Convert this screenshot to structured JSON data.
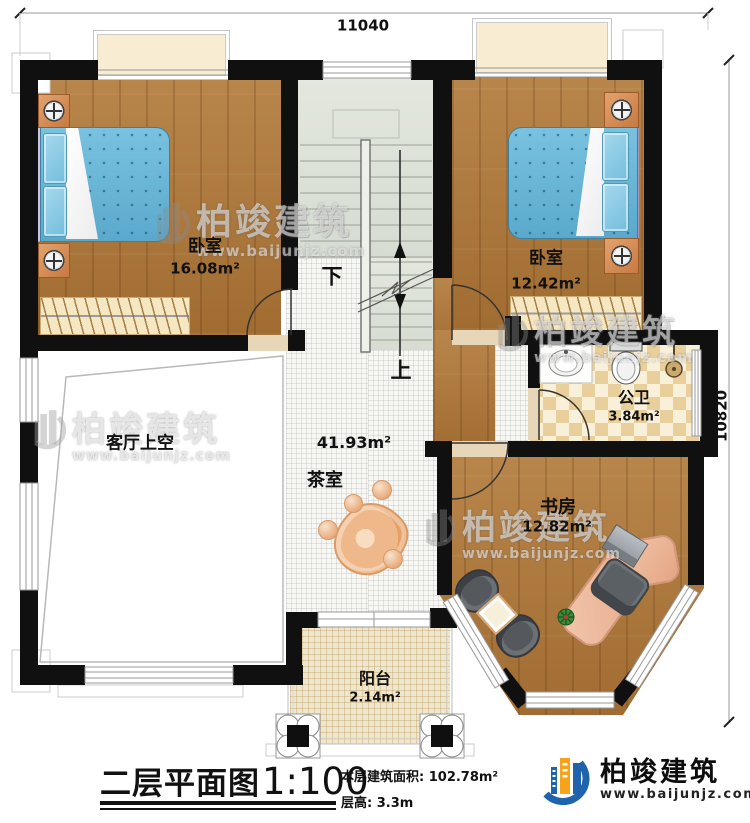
{
  "dimensions": {
    "top": "11040",
    "right": "10820"
  },
  "rooms": {
    "bedroom_left": {
      "name": "卧室",
      "area": "16.08m²"
    },
    "bedroom_right": {
      "name": "卧室",
      "area": "12.42m²"
    },
    "bathroom": {
      "name": "公卫",
      "area": "3.84m²"
    },
    "study": {
      "name": "书房",
      "area": "12.82m²"
    },
    "tea_room": {
      "name": "茶室",
      "area": "41.93m²"
    },
    "living_room_void": {
      "name": "客厅上空"
    },
    "balcony": {
      "name": "阳台",
      "area": "2.14m²"
    }
  },
  "stairs": {
    "down_label": "下",
    "up_label": "上"
  },
  "title_block": {
    "title": "二层平面图",
    "scale": "1:100",
    "area_line": "本层建筑面积: 102.78m²",
    "height_line": "层高: 3.3m"
  },
  "logo": {
    "brand": "柏竣建筑",
    "url": "www.baijunjz.com"
  },
  "watermark": {
    "brand": "柏竣建筑",
    "url": "www.baijunjz.com"
  },
  "colors": {
    "wall": "#111111",
    "wood_floor": "#ae7a3f",
    "bed": "#68b6d8",
    "stair_floor": "#dfe3da",
    "bath_tile_dark": "#e9cf9b",
    "bath_tile_light": "#f8f0d9",
    "logo_blue": "#1f63ad",
    "logo_orange": "#f7a21b"
  }
}
